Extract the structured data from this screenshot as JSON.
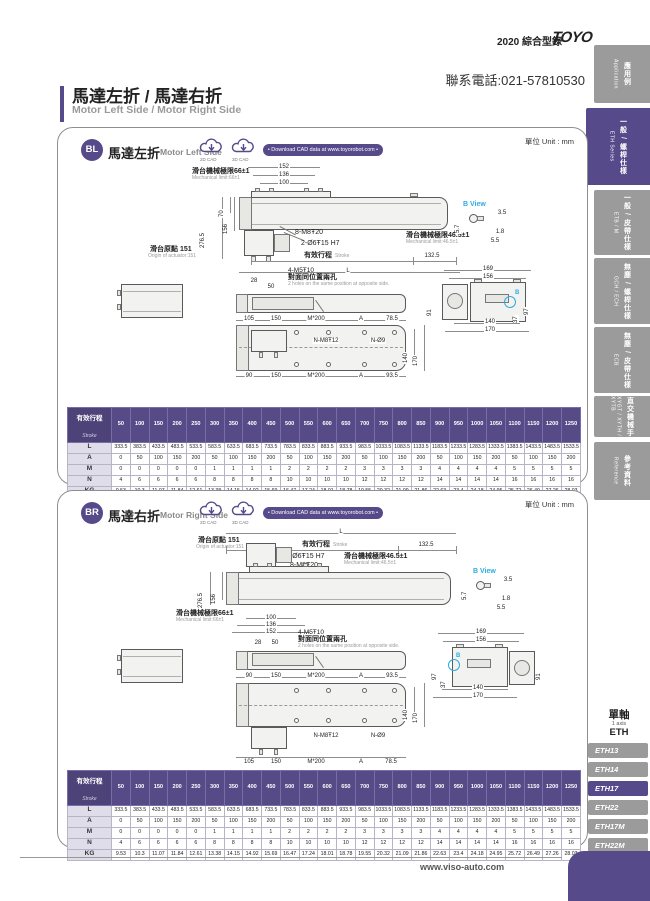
{
  "header": {
    "catalog": "2020 綜合型錄",
    "brand": "TOYO",
    "phone": "聯系電話:021-57810530"
  },
  "title": {
    "zh": "馬達左折 / 馬達右折",
    "en": "Motor Left Side / Motor Right Side"
  },
  "unit_label": "單位 Unit : mm",
  "footer": {
    "site": "www.viso-auto.com"
  },
  "sidebar": {
    "tabs": [
      {
        "zh": "應用例",
        "en": "Application",
        "active": false
      },
      {
        "zh": "一般 / 螺桿仕樣",
        "en": "ETH Series",
        "active": true
      },
      {
        "zh": "一般 / 皮帶仕樣",
        "en": "ETB / M",
        "active": false
      },
      {
        "zh": "無塵 / 螺桿仕樣",
        "en": "GCH / ECH",
        "active": false
      },
      {
        "zh": "無塵 / 皮帶仕樣",
        "en": "ECB",
        "active": false
      },
      {
        "zh": "直交機械手",
        "en": "XYGT / XYTH / XYTB",
        "active": false
      },
      {
        "zh": "參考資料",
        "en": "Reference",
        "active": false
      }
    ]
  },
  "model_nav": {
    "group_zh": "單軸",
    "group_en": "1 axis",
    "group_code": "ETH",
    "items": [
      {
        "label": "ETH13",
        "active": false
      },
      {
        "label": "ETH14",
        "active": false
      },
      {
        "label": "ETH17",
        "active": true
      },
      {
        "label": "ETH22",
        "active": false
      },
      {
        "label": "ETH17M",
        "active": false
      },
      {
        "label": "ETH22M",
        "active": false
      }
    ]
  },
  "cad": {
    "d2": "2D CAD",
    "d3": "3D CAD",
    "download": "• Download CAD data at www.toyorobot.com •"
  },
  "panels": {
    "bl": {
      "code": "BL",
      "zh": "馬達左折",
      "en": "Motor Left Side",
      "side": {
        "top_chain": [
          "152",
          "136",
          "100"
        ],
        "mech66_zh": "滑台機械極限66±1",
        "mech66_en": "Mechanical limit:66±1",
        "v276": "276.5",
        "v70": "70",
        "v156": "156",
        "origin_zh": "滑台原點 151",
        "origin_en": "Origin of actuator:151",
        "tap": "8-M8Ŧ20",
        "pin": "2-Ø6Ŧ15 H7",
        "stroke_zh": "有效行程",
        "stroke_en": "Stroke",
        "d132": "132.5",
        "L": "L",
        "mech46_zh": "滑台機械極限46.5±1",
        "mech46_en": "Mechanical limit:46.5±1"
      },
      "bview": {
        "title": "B View",
        "d35": "3.5",
        "d57": "5.7",
        "d18": "1.8",
        "d55": "5.5"
      },
      "end": {
        "d169": "169",
        "d156": "156",
        "d91": "91",
        "d97": "97",
        "d37": "37",
        "d140": "140",
        "d170": "170",
        "marker": "B"
      },
      "top": {
        "d28": "28",
        "d50": "50",
        "tap": "4-M5Ŧ10",
        "note_zh": "對面同位置兩孔",
        "note_en": "2 holes on the same position at opposite side.",
        "row_a": [
          "105",
          "150",
          "M*200",
          "A",
          "78.5"
        ],
        "row_b": [
          "90",
          "150",
          "M*200",
          "A",
          "93.5"
        ],
        "tap_n": "N-M8Ŧ12",
        "drill_n": "N-Ø9",
        "d140": "140",
        "d170": "170"
      }
    },
    "br": {
      "code": "BR",
      "zh": "馬達右折",
      "en": "Motor Right Side",
      "side": {
        "bottom_chain": [
          "100",
          "136",
          "152"
        ],
        "mech66_zh": "滑台機械極限66±1",
        "mech66_en": "Mechanical limit:66±1",
        "v276": "276.5",
        "v156": "156",
        "origin_zh": "滑台原點 151",
        "origin_en": "Origin of actuator:151",
        "tap": "8-M8Ŧ20",
        "pin": "2-Ø6Ŧ15 H7",
        "stroke_zh": "有效行程",
        "stroke_en": "Stroke",
        "d132": "132.5",
        "L": "L",
        "mech46_zh": "滑台機械極限46.5±1",
        "mech46_en": "Mechanical limit:46.5±1"
      },
      "bview": {
        "title": "B View",
        "d35": "3.5",
        "d57": "5.7",
        "d18": "1.8",
        "d55": "5.5"
      },
      "end": {
        "d169": "169",
        "d156": "156",
        "d91": "91",
        "d97": "97",
        "d37": "37",
        "d140": "140",
        "d170": "170",
        "marker": "B"
      },
      "top": {
        "d28": "28",
        "d50": "50",
        "tap": "4-M5Ŧ10",
        "note_zh": "對面同位置兩孔",
        "note_en": "2 holes on the same position at opposite side.",
        "row_a": [
          "90",
          "150",
          "M*200",
          "A",
          "93.5"
        ],
        "row_b": [
          "105",
          "150",
          "M*200",
          "A",
          "78.5"
        ],
        "tap_n": "N-M8Ŧ12",
        "drill_n": "N-Ø9",
        "d140": "140",
        "d170": "170"
      }
    }
  },
  "stroke_table": {
    "header_zh": "有效行程",
    "header_en": "Stroke",
    "strokes": [
      "50",
      "100",
      "150",
      "200",
      "250",
      "300",
      "350",
      "400",
      "450",
      "500",
      "550",
      "600",
      "650",
      "700",
      "750",
      "800",
      "850",
      "900",
      "950",
      "1000",
      "1050",
      "1100",
      "1150",
      "1200",
      "1250"
    ],
    "rows": [
      {
        "label": "L",
        "values": [
          "333.5",
          "383.5",
          "433.5",
          "483.5",
          "533.5",
          "583.5",
          "633.5",
          "683.5",
          "733.5",
          "783.5",
          "833.5",
          "883.5",
          "933.5",
          "983.5",
          "1033.5",
          "1083.5",
          "1133.5",
          "1183.5",
          "1233.5",
          "1283.5",
          "1333.5",
          "1383.5",
          "1433.5",
          "1483.5",
          "1533.5"
        ]
      },
      {
        "label": "A",
        "values": [
          "0",
          "50",
          "100",
          "150",
          "200",
          "50",
          "100",
          "150",
          "200",
          "50",
          "100",
          "150",
          "200",
          "50",
          "100",
          "150",
          "200",
          "50",
          "100",
          "150",
          "200",
          "50",
          "100",
          "150",
          "200"
        ]
      },
      {
        "label": "M",
        "values": [
          "0",
          "0",
          "0",
          "0",
          "0",
          "1",
          "1",
          "1",
          "1",
          "2",
          "2",
          "2",
          "2",
          "3",
          "3",
          "3",
          "3",
          "4",
          "4",
          "4",
          "4",
          "5",
          "5",
          "5",
          "5"
        ]
      },
      {
        "label": "N",
        "values": [
          "4",
          "6",
          "6",
          "6",
          "6",
          "8",
          "8",
          "8",
          "8",
          "10",
          "10",
          "10",
          "10",
          "12",
          "12",
          "12",
          "12",
          "14",
          "14",
          "14",
          "14",
          "16",
          "16",
          "16",
          "16"
        ]
      },
      {
        "label": "KG",
        "values": [
          "9.53",
          "10.3",
          "11.07",
          "11.84",
          "12.61",
          "13.38",
          "14.15",
          "14.92",
          "15.69",
          "16.47",
          "17.24",
          "18.01",
          "18.78",
          "19.55",
          "20.32",
          "21.09",
          "21.86",
          "22.63",
          "23.4",
          "24.18",
          "24.95",
          "25.72",
          "26.49",
          "27.26",
          "28.03"
        ]
      }
    ]
  }
}
